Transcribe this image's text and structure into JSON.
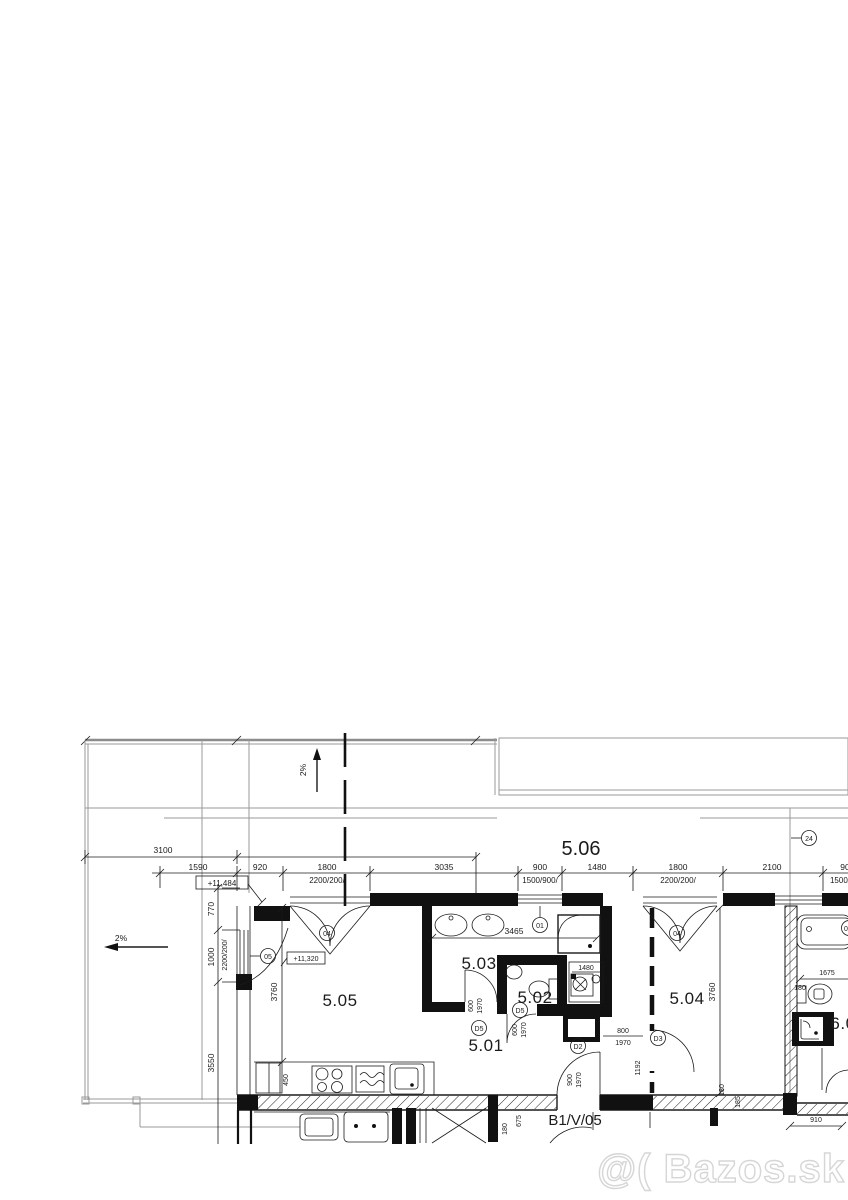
{
  "watermark": {
    "label": "@( Bazos.sk"
  },
  "plan": {
    "slope_up": "2%",
    "slope_left": "2%",
    "level_upper": "+11,484",
    "level_lower": "+11,320",
    "rooms": {
      "r501": "5.01",
      "r502": "5.02",
      "r503": "5.03",
      "r504": "5.04",
      "r505": "5.05",
      "r506": "5.06",
      "r6": "6.0",
      "neighbor_unit": "B1/V/05"
    },
    "markers": {
      "window_01": "01",
      "door_04_a": "04",
      "door_04_b": "04",
      "window_05": "05",
      "door_d5_a": "D5",
      "door_d5_b": "D5",
      "door_d2": "D2",
      "door_d3": "D3",
      "section_24": "24",
      "edge_cut": "0"
    },
    "dims": {
      "row1_3100": "3100",
      "row2": {
        "d1590": "1590",
        "d920": "920",
        "d1800a": "1800",
        "d3035": "3035",
        "d900a": "900",
        "d1480": "1480",
        "d1800b": "1800",
        "d2100": "2100",
        "d90": "90"
      },
      "row2_sub": {
        "s1": "2200/200/",
        "s2": "1500/900/",
        "s3": "2200/200/",
        "s4": "1500/"
      },
      "left": {
        "d770": "770",
        "d1000": "1000",
        "sub": "2200/200/",
        "d3550": "3550"
      },
      "v3760a": "3760",
      "v3760b": "3760",
      "bath3465": "3465",
      "right1675": "1675",
      "right180": "180",
      "niche1480": "1480",
      "kitchen450": "450",
      "door503_w": "600",
      "door503_h": "1970",
      "door502_w": "600",
      "door502_h": "1970",
      "door_d3_w": "800",
      "door_d3_h": "1970",
      "off1192": "1192",
      "door_d2_w": "900",
      "door_d2_h": "1970",
      "b675": "675",
      "b180": "180",
      "b180b": "180",
      "b185": "185",
      "b910": "910"
    }
  }
}
